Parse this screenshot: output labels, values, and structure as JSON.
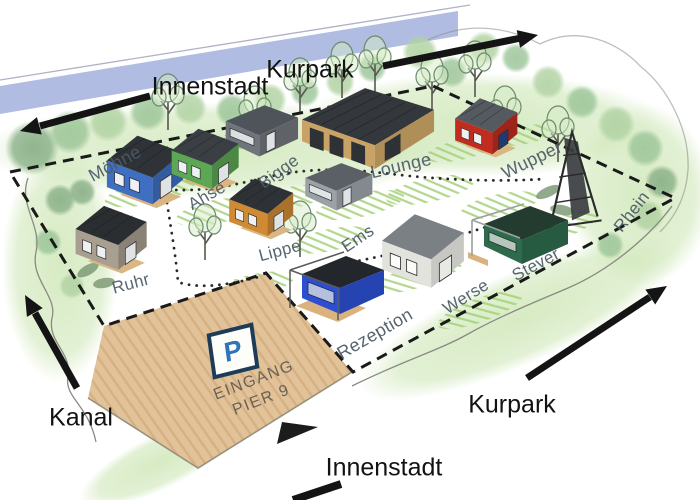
{
  "map": {
    "area_labels": {
      "innenstadt_top": "Innenstadt",
      "kurpark_top": "Kurpark",
      "kanal": "Kanal",
      "kurpark_bottom": "Kurpark",
      "innenstadt_bottom": "Innenstadt"
    },
    "parking": {
      "sign": "P",
      "entrance_line1": "EINGANG",
      "entrance_line2": "PIER 9"
    },
    "houses": [
      {
        "id": "moehne",
        "label": "Möhne",
        "color": "#3f6fc2",
        "roof": "#2f3338"
      },
      {
        "id": "ruhr",
        "label": "Ruhr",
        "color": "#a99f90",
        "roof": "#2b2e31"
      },
      {
        "id": "ahse",
        "label": "Ahse",
        "color": "#5ca754",
        "roof": "#3a3f44"
      },
      {
        "id": "lippe",
        "label": "Lippe",
        "color": "#cf8a33",
        "roof": "#2e3236"
      },
      {
        "id": "bigge",
        "label": "Bigge",
        "color": "#70757b",
        "roof": "#4e545a"
      },
      {
        "id": "lounge",
        "label": "Lounge",
        "color": "#c9a265",
        "roof": "#34383c"
      },
      {
        "id": "wupper",
        "label": "Wupper",
        "color": "#c02d20",
        "roof": "#555a60"
      },
      {
        "id": "ems",
        "label": "Ems",
        "color": "#9aa1a7",
        "roof": "#5a6066"
      },
      {
        "id": "rezeption",
        "label": "Rezeption",
        "color": "#2c4fd1",
        "roof": "#23262b"
      },
      {
        "id": "werse",
        "label": "Werse",
        "color": "#e3e3de",
        "roof": "#7b8084"
      },
      {
        "id": "stever",
        "label": "Stever",
        "color": "#2e6b4d",
        "roof": "#243b2f"
      },
      {
        "id": "rhein",
        "label": "Rhein",
        "color": "#3a3d40",
        "roof": "#2b2e31"
      }
    ],
    "colors": {
      "water": "#a9b5e0",
      "parking": "#e2c299",
      "deck": "#d9b27e",
      "arrow": "#141414",
      "boundary": "#1a1a1a",
      "river_label": "#4b5a66",
      "area_label": "#121212",
      "sign_border": "#1e3c55",
      "sign_p": "#2e74b8",
      "entrance_text": "#6a6156"
    }
  }
}
